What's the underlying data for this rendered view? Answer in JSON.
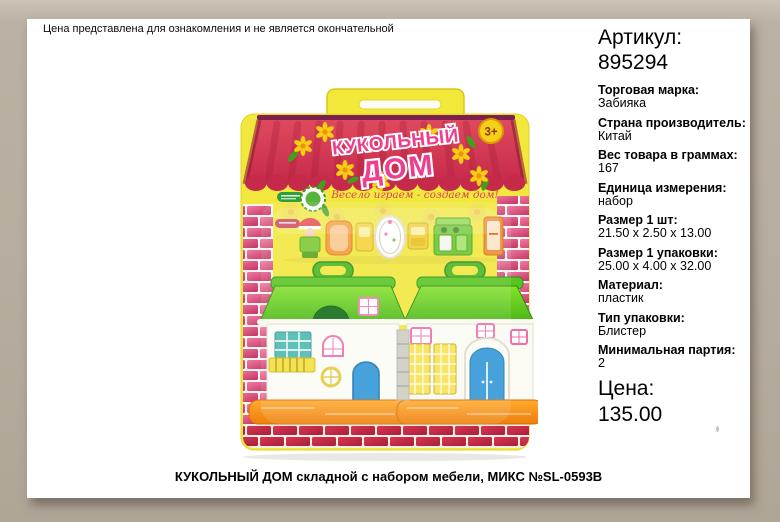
{
  "disclaimer": "Цена представлена для ознакомления и не является окончательной",
  "product_photo": {
    "logo_line1": "КУКОЛЬНЫЙ",
    "logo_line2": "ДОМ",
    "age_badge": "3+",
    "tagline": "Весело играем - создаем дом!"
  },
  "details": {
    "article_label": "Артикул:",
    "article_value": "895294",
    "fields": [
      {
        "label": "Торговая марка:",
        "value": "Забияка"
      },
      {
        "label": "Страна производитель:",
        "value": "Китай"
      },
      {
        "label": "Вес товара в граммах:",
        "value": "167"
      },
      {
        "label": "Единица измерения:",
        "value": "набор"
      },
      {
        "label": "Размер 1 шт:",
        "value": "21.50 x 2.50 x 13.00"
      },
      {
        "label": "Размер 1 упаковки:",
        "value": "25.00 x 4.00 x 32.00"
      },
      {
        "label": "Материал:",
        "value": "пластик"
      },
      {
        "label": "Тип упаковки:",
        "value": "Блистер"
      },
      {
        "label": "Минимальная партия:",
        "value": "2"
      }
    ],
    "price_label": "Цена:",
    "price_value": "135.00"
  },
  "caption": "КУКОЛЬНЫЙ ДОМ складной с набором мебели, МИКС №SL-0593B",
  "colors": {
    "frame": "#b6ac9f",
    "sheet": "#ffffff",
    "card_yellow": "#f2e73c",
    "curtain_red": "#d23650",
    "brick_pink": "#d94b78",
    "roof_green": "#5ecb1e",
    "base_orange": "#f59425",
    "door_blue": "#2e96d6",
    "logo_pink": "#ee3f8e",
    "text": "#000000"
  }
}
